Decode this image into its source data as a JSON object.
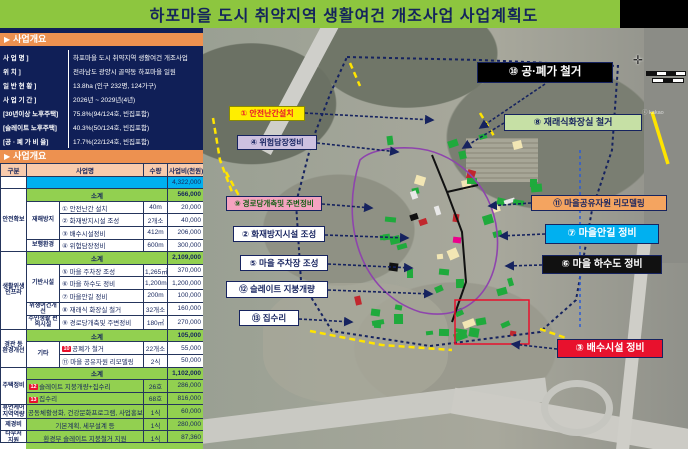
{
  "title": "하포마을 도시 취약지역 생활여건 개조사업 사업계획도",
  "overview": {
    "marker": "▶",
    "header": "사업개요",
    "rows": [
      {
        "label": "사  업  명 ]",
        "value": "하포마을 도시 취약지역 생활여건 개조사업"
      },
      {
        "label": "위  치 ]",
        "value": "전라남도 광양시 골약동 하포마을 일원"
      },
      {
        "label": "일 반 현 황 ]",
        "value": "13.8ha (인구 232명, 124가구)"
      },
      {
        "label": "사 업 기 간 ]",
        "value": "2026년 ~ 2029년(4년)"
      },
      {
        "label": "[30년이상 노후주택]",
        "value": "75.8%(94/124호, 빈집포함)"
      },
      {
        "label": "[슬레이트 노후주택]",
        "value": "40.3%(50/124호, 빈집포함)"
      },
      {
        "label": "[공 · 폐 가 비 율]",
        "value": "17.7%(22/124호, 빈집포함)"
      }
    ]
  },
  "budget": {
    "marker": "▶",
    "header": "사업개요",
    "rows": [
      {
        "cells": [
          {
            "t": "구분",
            "cl": "hdr"
          },
          {
            "t": "사업명",
            "cs": 2,
            "cl": "hdr"
          },
          {
            "t": "수량",
            "cl": "hdr"
          },
          {
            "t": "사업비(천원)",
            "cl": "hdr"
          }
        ]
      },
      {
        "cells": [
          {
            "t": ""
          },
          {
            "t": "",
            "cs": 3,
            "cl": "tot"
          },
          {
            "t": "4,322,000",
            "cl": "tot num"
          }
        ]
      },
      {
        "cells": [
          {
            "t": "안전확보",
            "rs": 5,
            "cl": "ga"
          },
          {
            "t": "소계",
            "cs": 3,
            "cl": "sub"
          },
          {
            "t": "566,000",
            "cl": "sub num"
          }
        ]
      },
      {
        "cells": [
          {
            "t": "재해방지",
            "rs": 3,
            "cl": "gb"
          },
          {
            "t": "① 안전난간 설치",
            "cl": "lft"
          },
          {
            "t": "40m"
          },
          {
            "t": "20,000",
            "cl": "num"
          }
        ]
      },
      {
        "cells": [
          {
            "t": "② 화재방지시설 조성",
            "cl": "lft"
          },
          {
            "t": "2개소"
          },
          {
            "t": "40,000",
            "cl": "num"
          }
        ]
      },
      {
        "cells": [
          {
            "t": "③ 배수시설정비",
            "cl": "lft"
          },
          {
            "t": "412m"
          },
          {
            "t": "206,000",
            "cl": "num"
          }
        ]
      },
      {
        "cells": [
          {
            "t": "보행환경",
            "cl": "gb"
          },
          {
            "t": "④ 위험담장정비",
            "cl": "lft"
          },
          {
            "t": "600m"
          },
          {
            "t": "300,000",
            "cl": "num"
          }
        ]
      },
      {
        "cells": [
          {
            "t": "생활위생 인프라",
            "rs": 6,
            "cl": "ga"
          },
          {
            "t": "소계",
            "cs": 3,
            "cl": "sub"
          },
          {
            "t": "2,109,000",
            "cl": "sub num"
          }
        ]
      },
      {
        "cells": [
          {
            "t": "기반시설",
            "rs": 3,
            "cl": "gb"
          },
          {
            "t": "⑤ 마을 주차장 조성",
            "cl": "lft"
          },
          {
            "t": "1,265㎡"
          },
          {
            "t": "370,000",
            "cl": "num"
          }
        ]
      },
      {
        "cells": [
          {
            "t": "⑥ 마을 하수도 정비",
            "cl": "lft"
          },
          {
            "t": "1,200m"
          },
          {
            "t": "1,200,000",
            "cl": "num"
          }
        ]
      },
      {
        "cells": [
          {
            "t": "⑦ 마을안길 정비",
            "cl": "lft"
          },
          {
            "t": "200m"
          },
          {
            "t": "100,000",
            "cl": "num"
          }
        ]
      },
      {
        "cells": [
          {
            "t": "위생여건개선",
            "cl": "gb"
          },
          {
            "t": "⑧ 재래식 화장실 철거",
            "cl": "lft"
          },
          {
            "t": "32개소"
          },
          {
            "t": "160,000",
            "cl": "num"
          }
        ]
      },
      {
        "cells": [
          {
            "t": "주민생활 편의시설",
            "cl": "gb"
          },
          {
            "t": "⑨ 경로당개축및 주변정비",
            "cl": "lft"
          },
          {
            "t": "180㎡"
          },
          {
            "t": "270,000",
            "cl": "num"
          }
        ]
      },
      {
        "cells": [
          {
            "t": "경관 등 환경개선",
            "rs": 3,
            "cl": "ga"
          },
          {
            "t": "소계",
            "cs": 3,
            "cl": "sub"
          },
          {
            "t": "105,000",
            "cl": "sub num"
          }
        ]
      },
      {
        "cells": [
          {
            "t": "기타",
            "rs": 2,
            "cl": "gb"
          },
          {
            "b": "10",
            "t": "공폐가 철거",
            "cl": "lft"
          },
          {
            "t": "22개소"
          },
          {
            "t": "55,000",
            "cl": "num"
          }
        ]
      },
      {
        "cells": [
          {
            "t": "⑪ 마을 공유자원 리모델링",
            "cl": "lft"
          },
          {
            "t": "2식"
          },
          {
            "t": "50,000",
            "cl": "num"
          }
        ]
      },
      {
        "cells": [
          {
            "t": "주택정비",
            "rs": 3,
            "cl": "ga"
          },
          {
            "t": "소계",
            "cs": 3,
            "cl": "sub"
          },
          {
            "t": "1,102,000",
            "cl": "sub num"
          }
        ]
      },
      {
        "cells": [
          {
            "b": "12",
            "t": "슬레이트 지붕개량+집수리",
            "cs": 2,
            "cl": "g lft"
          },
          {
            "t": "26호",
            "cl": "g"
          },
          {
            "t": "286,000",
            "cl": "g num"
          }
        ]
      },
      {
        "cells": [
          {
            "b": "13",
            "t": "집수리",
            "cs": 2,
            "cl": "g lft"
          },
          {
            "t": "68호",
            "cl": "g"
          },
          {
            "t": "816,000",
            "cl": "g num"
          }
        ]
      },
      {
        "cells": [
          {
            "t": "휴먼케어 지역역량",
            "cl": "ga"
          },
          {
            "t": "공동체활성화, 건강문화프로그램, 사업홍보 등",
            "cs": 2,
            "cl": "g"
          },
          {
            "t": "1식",
            "cl": "g"
          },
          {
            "t": "60,000",
            "cl": "g num"
          }
        ]
      },
      {
        "cells": [
          {
            "t": "제경비",
            "cl": "ga"
          },
          {
            "t": "기본계획, 세부설계 등",
            "cs": 2,
            "cl": "g"
          },
          {
            "t": "1식",
            "cl": "g"
          },
          {
            "t": "280,000",
            "cl": "g num"
          }
        ]
      },
      {
        "cells": [
          {
            "t": "타부처 지원",
            "cl": "ga"
          },
          {
            "t": "환경부 슬레이트 지붕철거 지원",
            "cs": 2,
            "cl": "g"
          },
          {
            "t": "1식",
            "cl": "g"
          },
          {
            "t": "87,360",
            "cl": "g num"
          }
        ]
      }
    ]
  },
  "map": {
    "watermark": "ⓒ kakao",
    "labels": [
      {
        "id": "1",
        "text": "① 안전난간설치",
        "bg": "#ffee00",
        "color": "#e8112d",
        "bd": "#8a8a00"
      },
      {
        "id": "4",
        "text": "④ 위험담장정비",
        "bg": "#cdc1e0",
        "color": "#16235f"
      },
      {
        "id": "9",
        "text": "⑨ 경로당개축및 주변정비",
        "bg": "#f5a3c0",
        "color": "#155f15"
      },
      {
        "id": "2",
        "text": "② 화재방지시설 조성",
        "bg": "#ffffff",
        "color": "#16235f"
      },
      {
        "id": "5",
        "text": "⑤ 마을 주차장 조성",
        "bg": "#ffffff",
        "color": "#16235f"
      },
      {
        "id": "12",
        "text": "⑫ 슬레이트 지붕개량",
        "bg": "#ffffff",
        "color": "#16235f"
      },
      {
        "id": "13",
        "text": "⑬ 집수리",
        "bg": "#ffffff",
        "color": "#16235f"
      },
      {
        "id": "10",
        "text": "⑩ 공·폐가 철거",
        "bg": "#000000",
        "color": "#ffffff"
      },
      {
        "id": "8",
        "text": "⑧ 재래식화장실 철거",
        "bg": "#c6e0a5",
        "color": "#16235f"
      },
      {
        "id": "11",
        "text": "⑪ 마을공유자원 리모델링",
        "bg": "#f4a460",
        "color": "#16235f"
      },
      {
        "id": "7",
        "text": "⑦ 마을안길 정비",
        "bg": "#00b0f0",
        "color": "#ffffff"
      },
      {
        "id": "6",
        "text": "⑥ 마을 하수도 정비",
        "bg": "#111111",
        "color": "#ffffff"
      },
      {
        "id": "3",
        "text": "③ 배수시설 정비",
        "bg": "#e8112d",
        "color": "#ffffff"
      }
    ]
  },
  "colors": {
    "title_bg": "#8dc63f",
    "accent_navy": "#16235f",
    "header_orange": "#ed9150",
    "table_header": "#f8cbad",
    "row_green": "#92d050",
    "row_blue": "#00b0f0",
    "badge_red": "#e8112d"
  }
}
